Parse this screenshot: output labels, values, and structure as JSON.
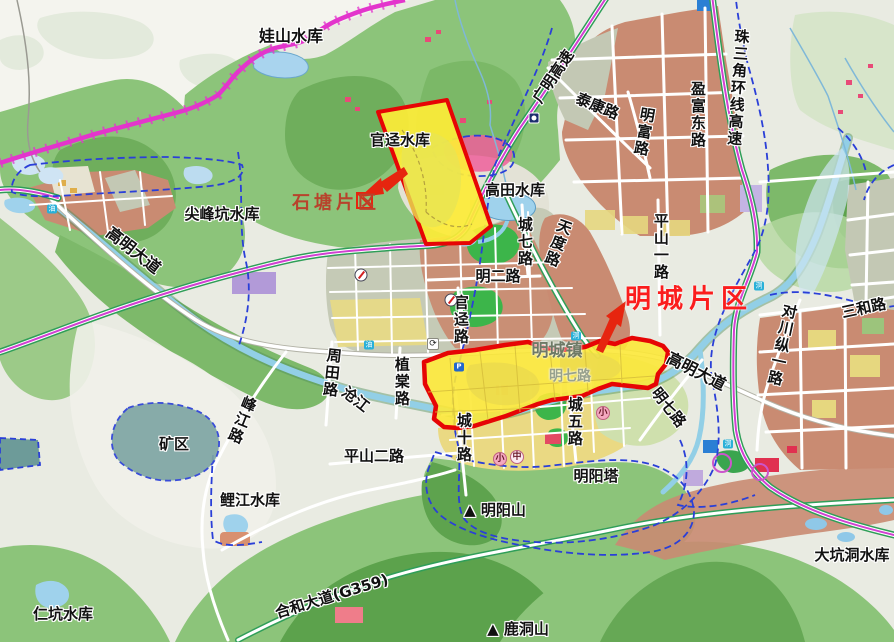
{
  "map_title": "明城镇规划图",
  "colors": {
    "zone_fill": "#fde93a",
    "zone_border": "#e60505",
    "highway_magenta": "#d23fd2",
    "expressway_green": "#2f9e58",
    "admin_boundary_magenta": "#e335cc",
    "district_boundary_blue": "#2a3fd8",
    "water": "#92cfe6",
    "urban_block": "#c98b72",
    "forest": "#8cc47a",
    "shitang_label_color": "#b8432c",
    "mingcheng_label_color": "#fb1d1d"
  },
  "labels": [
    {
      "id": "washan-reservoir",
      "text": "娃山水库",
      "x": 291,
      "y": 37,
      "size": 16
    },
    {
      "id": "guanjing-reservoir",
      "text": "官迳水库",
      "x": 400,
      "y": 141,
      "size": 15
    },
    {
      "id": "shitang-district",
      "text": "石塘片区",
      "x": 336,
      "y": 204,
      "size": 18,
      "color": "#b8432c",
      "spacing": 4,
      "halo": "none"
    },
    {
      "id": "jianfengkeng-reservoir",
      "text": "尖峰坑水库",
      "x": 222,
      "y": 215,
      "size": 15
    },
    {
      "id": "gaoming-avenue-west",
      "text": "高明大道",
      "x": 133,
      "y": 251,
      "size": 16,
      "rotate": 38
    },
    {
      "id": "gaotian-reservoir",
      "text": "高田水库",
      "x": 515,
      "y": 191,
      "size": 15
    },
    {
      "id": "guangming-expressway",
      "text": "广明高速",
      "x": 554,
      "y": 77,
      "size": 15,
      "rotate": -56
    },
    {
      "id": "taikang-road",
      "text": "泰康路",
      "x": 597,
      "y": 107,
      "size": 15,
      "rotate": 22
    },
    {
      "id": "mingfu-road",
      "text": "明富路",
      "x": 643,
      "y": 132,
      "size": 15,
      "vertical": true,
      "rotate": 10
    },
    {
      "id": "yingfudong-road",
      "text": "盈富东路",
      "x": 697,
      "y": 115,
      "size": 15,
      "vertical": true
    },
    {
      "id": "zhusanjiao-ring-expressway",
      "text": "珠三角环线高速",
      "x": 737,
      "y": 88,
      "size": 15,
      "vertical": true,
      "rotate": 4
    },
    {
      "id": "chengqi-road",
      "text": "城七路",
      "x": 524,
      "y": 242,
      "size": 15,
      "vertical": true
    },
    {
      "id": "tiandu-road",
      "text": "天度路",
      "x": 557,
      "y": 243,
      "size": 15,
      "vertical": true,
      "rotate": 20
    },
    {
      "id": "ming-er-road",
      "text": "明二路",
      "x": 498,
      "y": 277,
      "size": 15
    },
    {
      "id": "pingshan-yi-road",
      "text": "平山一路",
      "x": 660,
      "y": 247,
      "size": 15,
      "vertical": true
    },
    {
      "id": "guanjing-road",
      "text": "官迳路",
      "x": 460,
      "y": 320,
      "size": 15,
      "vertical": true
    },
    {
      "id": "mingcheng-district",
      "text": "明城片区",
      "x": 689,
      "y": 300,
      "size": 26,
      "color": "#fb1d1d",
      "spacing": 6,
      "halo": "light"
    },
    {
      "id": "zhoutian-road",
      "text": "周田路",
      "x": 331,
      "y": 373,
      "size": 15,
      "vertical": true,
      "rotate": 6
    },
    {
      "id": "cangjiang-river",
      "text": "沧江",
      "x": 355,
      "y": 400,
      "size": 15,
      "rotate": 38
    },
    {
      "id": "zhitang-road",
      "text": "植棠路",
      "x": 401,
      "y": 382,
      "size": 15,
      "vertical": true
    },
    {
      "id": "fengjiang-road",
      "text": "峰江路",
      "x": 241,
      "y": 420,
      "size": 15,
      "vertical": true,
      "rotate": 22
    },
    {
      "id": "mining-area",
      "text": "矿区",
      "x": 174,
      "y": 445,
      "size": 15
    },
    {
      "id": "pingshan-er-road",
      "text": "平山二路",
      "x": 374,
      "y": 457,
      "size": 15
    },
    {
      "id": "chengshi-road",
      "text": "城十路",
      "x": 463,
      "y": 438,
      "size": 15,
      "vertical": true
    },
    {
      "id": "chengwu-road",
      "text": "城五路",
      "x": 574,
      "y": 422,
      "size": 15,
      "vertical": true
    },
    {
      "id": "mingqi-road-east",
      "text": "明七路",
      "x": 668,
      "y": 408,
      "size": 15,
      "rotate": 52
    },
    {
      "id": "gaoming-avenue-east",
      "text": "高明大道",
      "x": 696,
      "y": 372,
      "size": 16,
      "rotate": 27
    },
    {
      "id": "mingyang-pagoda",
      "text": "明阳塔",
      "x": 596,
      "y": 477,
      "size": 15
    },
    {
      "id": "mingyang-mountain",
      "text": "▲ 明阳山",
      "x": 495,
      "y": 511,
      "size": 15
    },
    {
      "id": "lijiang-reservoir",
      "text": "鲤江水库",
      "x": 250,
      "y": 501,
      "size": 15
    },
    {
      "id": "renkeng-reservoir",
      "text": "仁坑水库",
      "x": 63,
      "y": 615,
      "size": 15
    },
    {
      "id": "hehe-avenue-g359",
      "text": "合和大道(G359)",
      "x": 332,
      "y": 597,
      "size": 15,
      "rotate": -17
    },
    {
      "id": "ludong-mountain",
      "text": "▲ 鹿洞山",
      "x": 518,
      "y": 630,
      "size": 15
    },
    {
      "id": "dakengdong-reservoir",
      "text": "大坑洞水库",
      "x": 852,
      "y": 556,
      "size": 15
    },
    {
      "id": "sanhe-road",
      "text": "三和路",
      "x": 864,
      "y": 309,
      "size": 15,
      "rotate": -12
    },
    {
      "id": "duichuanzong-yi-road",
      "text": "对川纵一路",
      "x": 781,
      "y": 345,
      "size": 15,
      "vertical": true,
      "rotate": 12
    },
    {
      "id": "mingcheng-town",
      "text": "明城镇",
      "x": 557,
      "y": 352,
      "size": 17,
      "color": "#6e7a66",
      "halo": "light"
    },
    {
      "id": "mingqi-road-inner",
      "text": "明七路",
      "x": 570,
      "y": 377,
      "size": 14,
      "color": "#98a18d",
      "halo": "light"
    }
  ],
  "markers": [
    {
      "type": "toll",
      "x": 361,
      "y": 275,
      "name": "toll-station-icon"
    },
    {
      "type": "toll",
      "x": 451,
      "y": 300,
      "name": "toll-station-icon"
    },
    {
      "type": "interchange",
      "text": "⟳",
      "x": 433,
      "y": 344,
      "name": "interchange-icon"
    },
    {
      "type": "metro",
      "x": 534,
      "y": 118,
      "name": "station-icon"
    },
    {
      "type": "badge",
      "text": "油",
      "x": 52,
      "y": 209,
      "name": "gas-station-icon"
    },
    {
      "type": "badge",
      "text": "油",
      "x": 369,
      "y": 345,
      "name": "gas-station-icon"
    },
    {
      "type": "badge",
      "text": "泂",
      "x": 576,
      "y": 336,
      "name": "river-gauge-icon"
    },
    {
      "type": "badge",
      "text": "泂",
      "x": 759,
      "y": 286,
      "name": "river-gauge-icon"
    },
    {
      "type": "badge",
      "text": "泂",
      "x": 728,
      "y": 444,
      "name": "river-gauge-icon"
    },
    {
      "type": "badge-blue",
      "text": "P",
      "x": 459,
      "y": 367,
      "name": "parking-icon"
    },
    {
      "type": "school",
      "text": "小",
      "x": 603,
      "y": 413,
      "name": "primary-school-icon"
    },
    {
      "type": "school",
      "text": "小",
      "x": 500,
      "y": 459,
      "name": "primary-school-icon"
    },
    {
      "type": "school2",
      "text": "中",
      "x": 517,
      "y": 457,
      "name": "middle-school-icon"
    }
  ]
}
